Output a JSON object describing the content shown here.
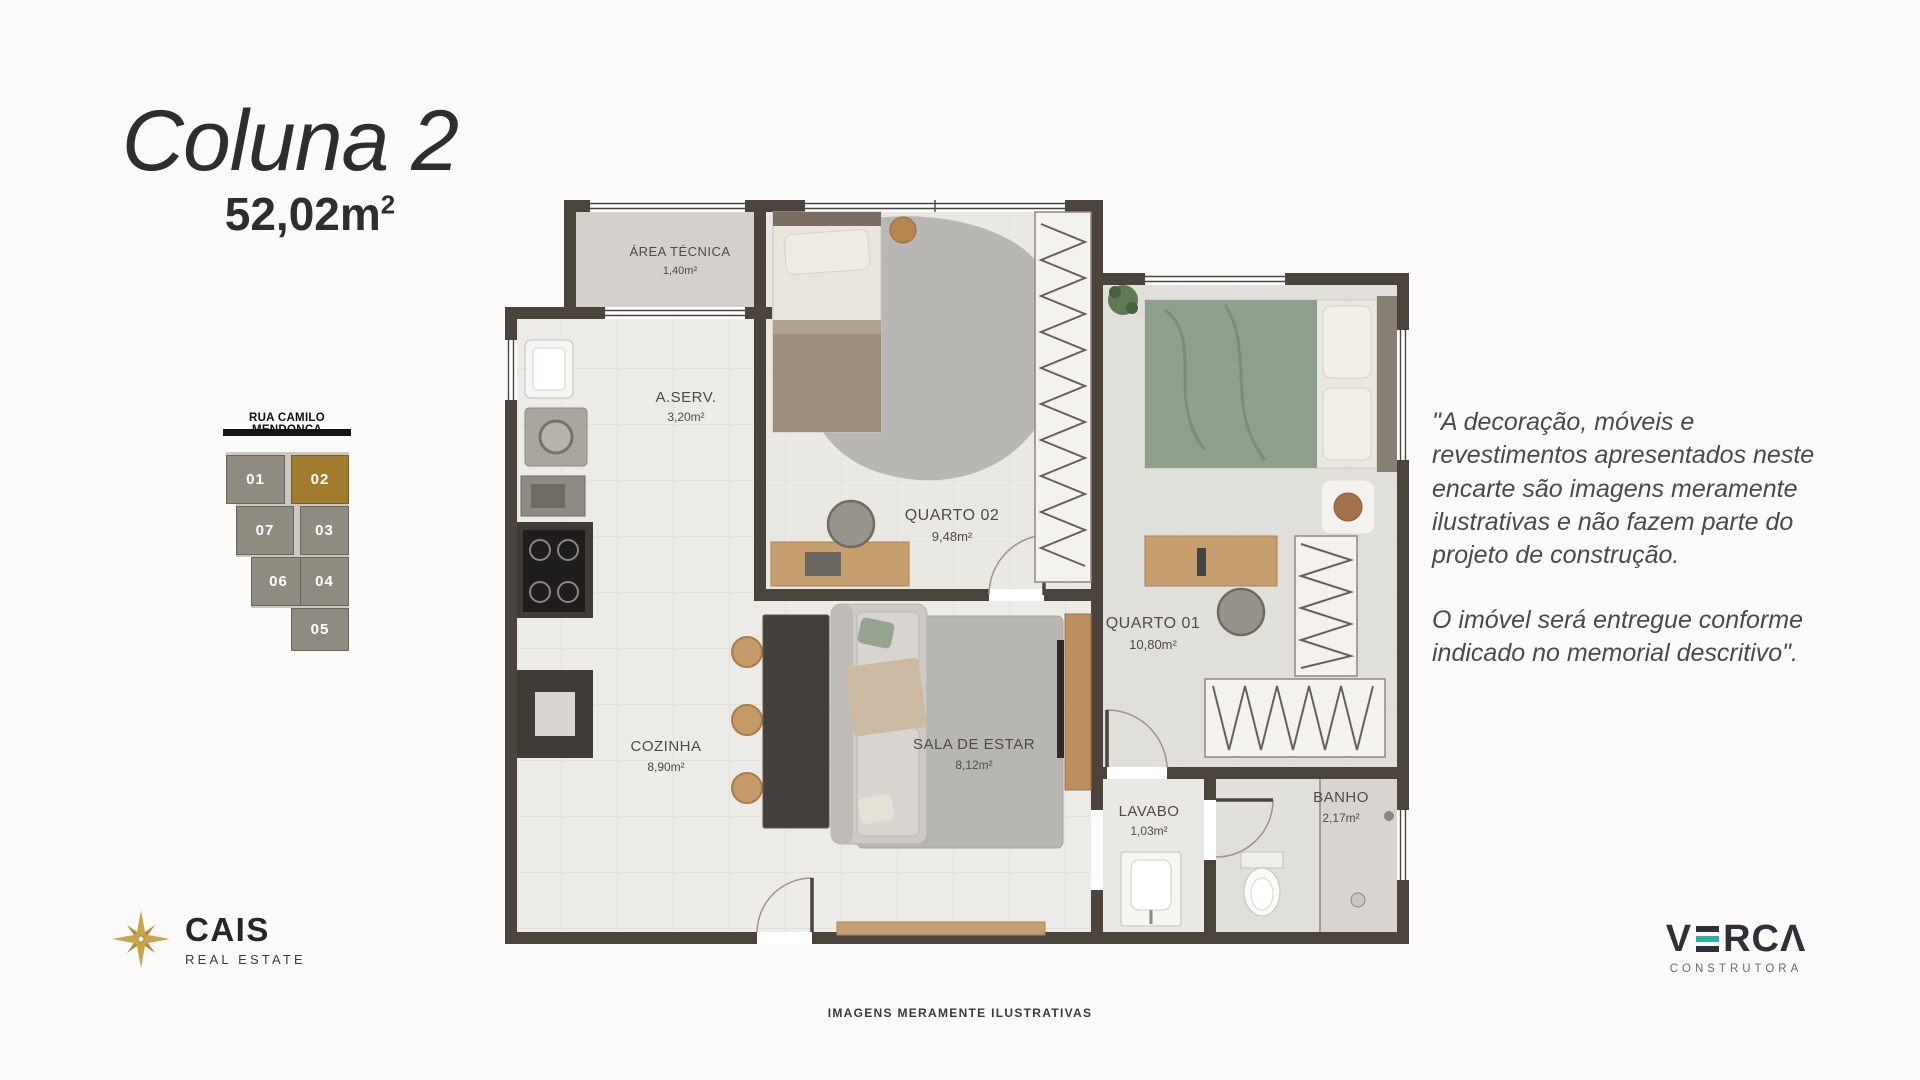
{
  "header": {
    "title": "Coluna 2",
    "area_value": "52,02m",
    "area_sup": "2"
  },
  "unit_map": {
    "street": "RUA CAMILO MENDONÇA",
    "highlight_color": "#a17c2d",
    "block_color": "#8f8b80",
    "units": [
      {
        "id": "01",
        "highlighted": false
      },
      {
        "id": "02",
        "highlighted": true
      },
      {
        "id": "07",
        "highlighted": false
      },
      {
        "id": "03",
        "highlighted": false
      },
      {
        "id": "06",
        "highlighted": false
      },
      {
        "id": "04",
        "highlighted": false
      },
      {
        "id": "05",
        "highlighted": false
      }
    ]
  },
  "plan": {
    "wall_color": "#4a443d",
    "rooms": [
      {
        "name": "ÁREA TÉCNICA",
        "area": "1,40m²"
      },
      {
        "name": "A.SERV.",
        "area": "3,20m²"
      },
      {
        "name": "QUARTO 02",
        "area": "9,48m²"
      },
      {
        "name": "QUARTO 01",
        "area": "10,80m²"
      },
      {
        "name": "COZINHA",
        "area": "8,90m²"
      },
      {
        "name": "SALA DE ESTAR",
        "area": "8,12m²"
      },
      {
        "name": "LAVABO",
        "area": "1,03m²"
      },
      {
        "name": "BANHO",
        "area": "2,17m²"
      }
    ]
  },
  "disclaimer": {
    "p1": "\"A decoração, móveis e revestimentos apresentados neste encarte são imagens meramente ilustrativas e não fazem parte do projeto de construção.",
    "p2": "O imóvel será entregue conforme indicado no memorial descritivo\"."
  },
  "footer_note": "IMAGENS MERAMENTE ILUSTRATIVAS",
  "brands": {
    "cais": {
      "name": "CAIS",
      "subtitle": "REAL ESTATE",
      "gold": "#c9a44e"
    },
    "verca": {
      "v": "V",
      "rest": "RCΛ",
      "subtitle": "CONSTRUTORA",
      "teal": "#29b3a0"
    }
  }
}
